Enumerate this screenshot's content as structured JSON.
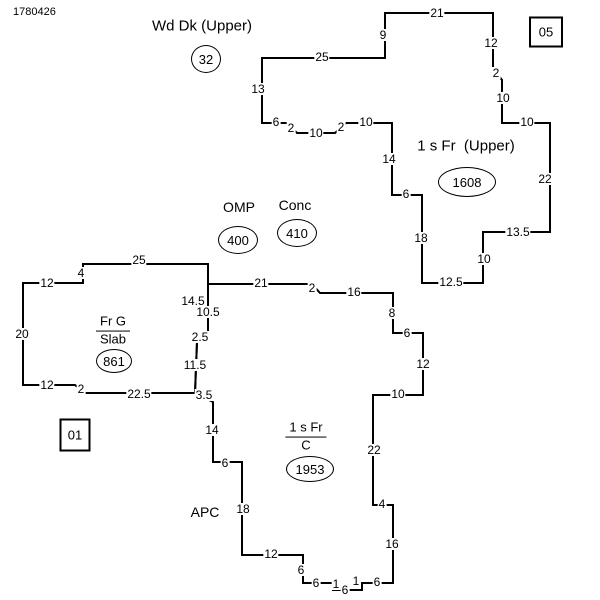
{
  "meta": {
    "document_id": "1780426"
  },
  "sketch": {
    "stroke_color": "#000000",
    "background_color": "#ffffff",
    "polygons": [
      {
        "name": "upper-deck-and-upper-floor-outline",
        "points": "262,58 385,58 385,13 493,13 493,68 502,80 502,123 550,123 550,232 483,232 483,283 422,283 422,195 392,195 392,123 346,123 335,133 297,133 287,123 262,123"
      },
      {
        "name": "garage-slab-outline",
        "points": "83,264 208,264 208,332 197,342 195,393 85,393 75,385 23,385 23,283 83,283"
      },
      {
        "name": "main-floor-outline",
        "points": "208,284 312,284 320,293 393,293 393,333 423,333 423,395 373,395 373,505 393,505 393,583 362,583 362,590 333,590 333,583 303,583 303,555 242,555 242,462 213,462 213,402 195,393 197,342 208,332"
      }
    ],
    "dimension_labels": [
      {
        "t": "21",
        "x": 437,
        "y": 13
      },
      {
        "t": "9",
        "x": 383,
        "y": 35
      },
      {
        "t": "25",
        "x": 322,
        "y": 57
      },
      {
        "t": "13",
        "x": 258,
        "y": 89
      },
      {
        "t": "12",
        "x": 491,
        "y": 43
      },
      {
        "t": "2",
        "x": 496,
        "y": 73
      },
      {
        "t": "10",
        "x": 503,
        "y": 98
      },
      {
        "t": "10",
        "x": 527,
        "y": 122
      },
      {
        "t": "22",
        "x": 545,
        "y": 179
      },
      {
        "t": "13.5",
        "x": 518,
        "y": 232
      },
      {
        "t": "10",
        "x": 484,
        "y": 259
      },
      {
        "t": "12.5",
        "x": 451,
        "y": 282
      },
      {
        "t": "18",
        "x": 421,
        "y": 238
      },
      {
        "t": "6",
        "x": 406,
        "y": 194
      },
      {
        "t": "14",
        "x": 389,
        "y": 159
      },
      {
        "t": "6",
        "x": 276,
        "y": 122
      },
      {
        "t": "2",
        "x": 291,
        "y": 128
      },
      {
        "t": "10",
        "x": 316,
        "y": 133
      },
      {
        "t": "2",
        "x": 341,
        "y": 127
      },
      {
        "t": "10",
        "x": 366,
        "y": 122
      },
      {
        "t": "25",
        "x": 139,
        "y": 260
      },
      {
        "t": "4",
        "x": 81,
        "y": 273
      },
      {
        "t": "12",
        "x": 47,
        "y": 283
      },
      {
        "t": "20",
        "x": 22,
        "y": 334
      },
      {
        "t": "12",
        "x": 47,
        "y": 385
      },
      {
        "t": "2",
        "x": 81,
        "y": 389
      },
      {
        "t": "22.5",
        "x": 139,
        "y": 394
      },
      {
        "t": "14.5",
        "x": 193,
        "y": 301
      },
      {
        "t": "10.5",
        "x": 208,
        "y": 312
      },
      {
        "t": "2.5",
        "x": 200,
        "y": 337
      },
      {
        "t": "11.5",
        "x": 195,
        "y": 365
      },
      {
        "t": "3.5",
        "x": 204,
        "y": 395
      },
      {
        "t": "21",
        "x": 261,
        "y": 283
      },
      {
        "t": "2",
        "x": 312,
        "y": 288
      },
      {
        "t": "16",
        "x": 354,
        "y": 292
      },
      {
        "t": "8",
        "x": 392,
        "y": 313
      },
      {
        "t": "6",
        "x": 407,
        "y": 333
      },
      {
        "t": "12",
        "x": 423,
        "y": 364
      },
      {
        "t": "10",
        "x": 398,
        "y": 394
      },
      {
        "t": "22",
        "x": 374,
        "y": 450
      },
      {
        "t": "4",
        "x": 382,
        "y": 504
      },
      {
        "t": "16",
        "x": 392,
        "y": 544
      },
      {
        "t": "6",
        "x": 377,
        "y": 582
      },
      {
        "t": "1",
        "x": 356,
        "y": 581
      },
      {
        "t": "6",
        "x": 345,
        "y": 590
      },
      {
        "t": "1",
        "x": 336,
        "y": 584
      },
      {
        "t": "6",
        "x": 316,
        "y": 583
      },
      {
        "t": "6",
        "x": 301,
        "y": 570
      },
      {
        "t": "12",
        "x": 271,
        "y": 554
      },
      {
        "t": "18",
        "x": 243,
        "y": 509
      },
      {
        "t": "6",
        "x": 225,
        "y": 463
      },
      {
        "t": "14",
        "x": 212,
        "y": 430
      }
    ],
    "plain_labels": [
      {
        "name": "label-wd-dk-upper",
        "text": "Wd Dk (Upper)",
        "x": 202,
        "y": 26,
        "kind": "lg"
      },
      {
        "name": "label-1s-fr-upper",
        "text": "1 s Fr  (Upper)",
        "x": 466,
        "y": 146,
        "kind": "lg"
      },
      {
        "name": "label-omp",
        "text": "OMP",
        "x": 239,
        "y": 207,
        "kind": "md"
      },
      {
        "name": "label-conc",
        "text": "Conc",
        "x": 295,
        "y": 205,
        "kind": "md"
      },
      {
        "name": "label-apc",
        "text": "APC",
        "x": 205,
        "y": 512,
        "kind": "md"
      }
    ],
    "fraction_labels": [
      {
        "name": "label-fr-g-slab",
        "top": "Fr G",
        "bottom": "Slab",
        "x": 113,
        "y": 331
      },
      {
        "name": "label-1s-fr-c",
        "top": "1 s Fr",
        "bottom": "C",
        "x": 306,
        "y": 437
      }
    ],
    "area_bubbles": [
      {
        "name": "area-wd-dk",
        "value": "32",
        "x": 206,
        "y": 59,
        "rx": 14,
        "ry": 13
      },
      {
        "name": "area-1s-fr-upper",
        "value": "1608",
        "x": 467,
        "y": 182,
        "rx": 28,
        "ry": 14
      },
      {
        "name": "area-omp",
        "value": "400",
        "x": 238,
        "y": 240,
        "rx": 19,
        "ry": 13
      },
      {
        "name": "area-conc",
        "value": "410",
        "x": 297,
        "y": 233,
        "rx": 19,
        "ry": 13
      },
      {
        "name": "area-fr-g-slab",
        "value": "861",
        "x": 114,
        "y": 361,
        "rx": 17,
        "ry": 11
      },
      {
        "name": "area-1s-fr-c",
        "value": "1953",
        "x": 310,
        "y": 469,
        "rx": 23,
        "ry": 12
      }
    ],
    "sequence_boxes": [
      {
        "name": "sequence-box-05",
        "text": "05",
        "x": 546,
        "y": 32,
        "w": 30,
        "h": 27
      },
      {
        "name": "sequence-box-01",
        "text": "01",
        "x": 75,
        "y": 435,
        "w": 27,
        "h": 29
      }
    ]
  }
}
